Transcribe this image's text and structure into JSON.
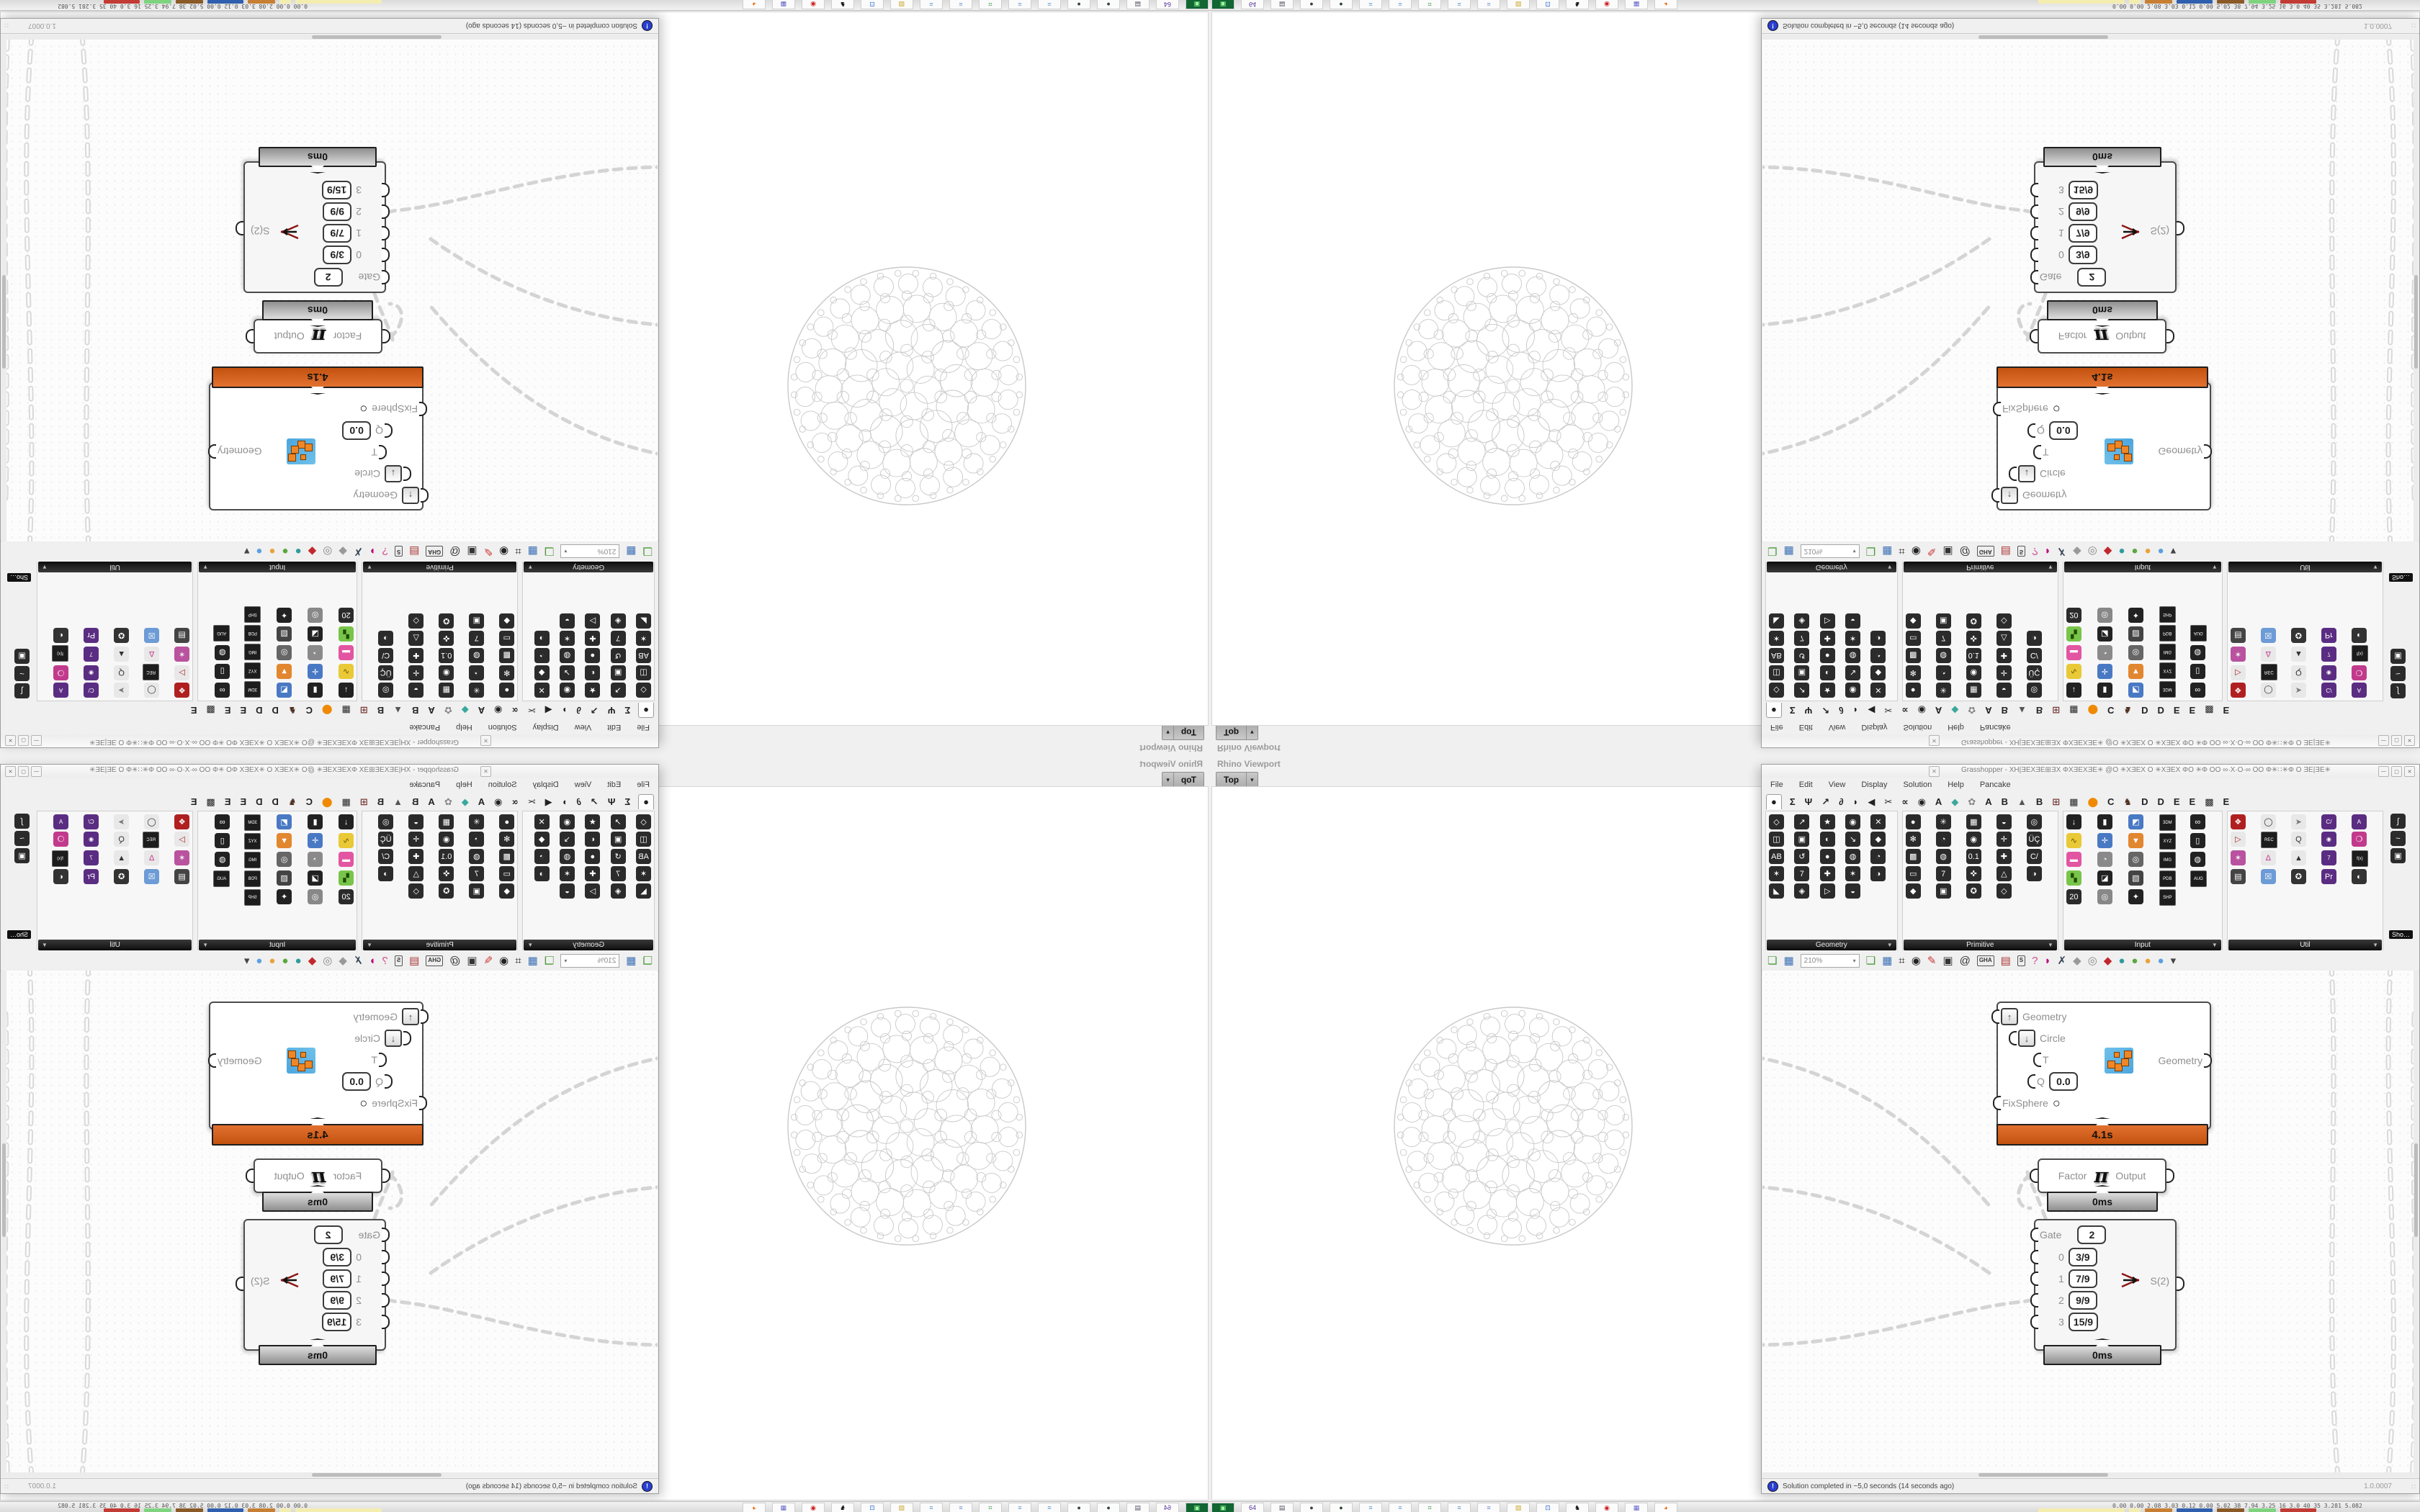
{
  "colors": {
    "chrome": "#f0f0f0",
    "canvas-bg": "#fcfcfc",
    "runtime": "#c4520f",
    "wire": "#d2d2d2"
  },
  "glyphs": {
    "dropdown": "▼",
    "small_down": "▾",
    "close": "✕",
    "minimize": "—",
    "maximize": "▢",
    "bang": "!",
    "grip": "∷"
  },
  "rhino": {
    "panel_title": "Rhino Viewport",
    "viewport_tab": "Top"
  },
  "gh": {
    "title": "Grasshopper - XH|ƎEXƎE⊞ƎX ΦXƎEXƎE✳ @O ✳XƎEX O ✳XƎEX ΦO ✳Φ OO ∞·X·O·∞ OO Φ✳∷✳Φ O ƎE|ƎE✳",
    "menu": [
      "File",
      "Edit",
      "View",
      "Display",
      "Solution",
      "Help",
      "Pancake"
    ],
    "tabs": [
      {
        "g": "●",
        "cls": "sel"
      },
      {
        "g": "Σ"
      },
      {
        "g": "Ψ"
      },
      {
        "g": "↗"
      },
      {
        "g": "∂"
      },
      {
        "g": "◗"
      },
      {
        "g": "◀"
      },
      {
        "g": "✂"
      },
      {
        "g": "∝"
      },
      {
        "g": "◉"
      },
      {
        "g": "A"
      },
      {
        "g": "◆",
        "fg": "#3aa89b"
      },
      {
        "g": "✿",
        "fg": "#888"
      },
      {
        "g": "A"
      },
      {
        "g": "B"
      },
      {
        "g": "▲",
        "fg": "#555"
      },
      {
        "g": "B"
      },
      {
        "g": "⊞",
        "fg": "#7a3c3c"
      },
      {
        "g": "▦"
      },
      {
        "g": "⬤",
        "fg": "#ef8a00"
      },
      {
        "g": "C"
      },
      {
        "g": "♞",
        "fg": "#4b2e1e"
      },
      {
        "g": "D"
      },
      {
        "g": "D"
      },
      {
        "g": "E"
      },
      {
        "g": "E"
      },
      {
        "g": "▩"
      },
      {
        "g": "E"
      }
    ],
    "palette": {
      "panels": [
        {
          "name": "Geometry",
          "cells": [
            "◇",
            "↗",
            "★",
            "◉",
            "✕",
            "◫",
            "▣",
            "◐",
            "↘",
            "◆",
            "AB",
            "↺",
            "●",
            "◍",
            "◔",
            "✶",
            "7",
            "✚",
            "✶",
            "◑",
            "◣",
            "◈",
            "▷",
            "◒"
          ]
        },
        {
          "name": "Primitive",
          "cells": [
            "●",
            "✳",
            "▦",
            "◒",
            "◎",
            "✻",
            "◔",
            "◉",
            "✛",
            "ÜÇ",
            "▩",
            "◍",
            "0.1",
            "✚",
            "C/",
            "▭",
            "7",
            "✜",
            "△",
            "◑",
            "◆",
            "▣",
            "✪",
            "◇"
          ]
        },
        {
          "name": "Input",
          "cells": [
            {
              "g": "↓",
              "bg": "#222"
            },
            {
              "g": "▮",
              "bg": "#222"
            },
            {
              "g": "◩",
              "bg": "#4a79c4"
            },
            {
              "g": "3DM",
              "cls": "chip"
            },
            {
              "g": "∞",
              "bg": "#222"
            },
            {
              "g": "∿",
              "bg": "#e9c937",
              "fg": "#6b5200"
            },
            {
              "g": "✛",
              "bg": "#4a79c4"
            },
            {
              "g": "▼",
              "bg": "#e2862f"
            },
            {
              "g": "XYZ",
              "cls": "chip"
            },
            {
              "g": "▯",
              "bg": "#222"
            },
            {
              "g": "▬",
              "bg": "#e255a2"
            },
            {
              "g": "◔",
              "bg": "#8a8a8a"
            },
            {
              "g": "◎",
              "bg": "#666"
            },
            {
              "g": "IMG",
              "cls": "chip"
            },
            {
              "g": "◍",
              "bg": "#222"
            },
            {
              "g": "▚",
              "bg": "#79c44a",
              "fg": "#1d4d00"
            },
            {
              "g": "◪",
              "bg": "#222"
            },
            {
              "g": "▧",
              "bg": "#444"
            },
            {
              "g": "PDB",
              "cls": "chip"
            },
            {
              "g": "AUG",
              "cls": "chip"
            },
            {
              "g": "20",
              "bg": "#2b2b2b"
            },
            {
              "g": "◎",
              "bg": "#888"
            },
            {
              "g": "✦",
              "bg": "#222"
            },
            {
              "g": "SHP",
              "cls": "chip"
            }
          ]
        },
        {
          "name": "Util",
          "cells": [
            {
              "g": "❖",
              "bg": "#b02020"
            },
            {
              "g": "◯",
              "bg": "#e8e8e8",
              "fg": "#333"
            },
            {
              "g": "➤",
              "bg": "#e8e8e8",
              "fg": "#777"
            },
            {
              "g": "C/",
              "cls": "chip-purple"
            },
            {
              "g": "A",
              "cls": "chip-purple"
            },
            {
              "g": "▷",
              "bg": "#e8e8e8",
              "fg": "#b02020"
            },
            {
              "g": "REC",
              "cls": "chip"
            },
            {
              "g": "Q",
              "bg": "#e8e8e8",
              "fg": "#333"
            },
            {
              "g": "◉",
              "cls": "chip-purple"
            },
            {
              "g": "❍",
              "bg": "#c23a8c"
            },
            {
              "g": "✶",
              "bg": "#b9529f"
            },
            {
              "g": "Δ",
              "bg": "#e8e8e8",
              "fg": "#c23a8c"
            },
            {
              "g": "▲",
              "bg": "#e8e8e8",
              "fg": "#333"
            },
            {
              "g": "7",
              "cls": "chip-purple"
            },
            {
              "g": "f(x)",
              "cls": "chip"
            },
            {
              "g": "▤",
              "bg": "#444"
            },
            {
              "g": "☒",
              "bg": "#6d9bd6"
            },
            {
              "g": "✪",
              "bg": "#333"
            },
            {
              "g": "Pr",
              "bg": "#5a2d82"
            },
            {
              "g": "◐",
              "bg": "#333"
            }
          ]
        }
      ],
      "extra_cells": [
        "∫",
        "~",
        "▣"
      ],
      "more_label": "Sho…"
    },
    "toolbar": {
      "zoom_value": "210%",
      "icons": [
        {
          "g": "❏",
          "fg": "#4a9a3a"
        },
        {
          "g": "▦",
          "fg": "#3b6fb5"
        },
        {
          "g": "⌗",
          "fg": "#222"
        },
        {
          "g": "◉",
          "fg": "#222"
        },
        {
          "g": "✎",
          "fg": "#c33"
        },
        {
          "g": "▣",
          "fg": "#333"
        },
        {
          "g": "@",
          "fg": "#333"
        },
        {
          "g": "GHA",
          "cls": "chip"
        },
        {
          "g": "▤",
          "fg": "#a33"
        },
        {
          "g": "S",
          "cls": "chip"
        },
        {
          "g": "?",
          "fg": "#d04a8e"
        },
        {
          "g": "◗",
          "fg": "#b07"
        },
        {
          "g": "✗",
          "fg": "#345"
        },
        {
          "g": "◆",
          "fg": "#999"
        },
        {
          "g": "◎",
          "fg": "#888"
        },
        {
          "g": "◆",
          "fg": "#c2272d"
        },
        {
          "g": "●",
          "fg": "#2e9c9c"
        },
        {
          "g": "●",
          "fg": "#58a83c"
        },
        {
          "g": "●",
          "fg": "#e8a23a"
        },
        {
          "g": "●",
          "fg": "#5aa0e0"
        },
        {
          "g": "▾",
          "fg": "#444"
        }
      ]
    },
    "canvas": {
      "main_component": {
        "time": "4.1s",
        "output": "Geometry",
        "inputs": [
          {
            "label": "Geometry",
            "arrow": "↑"
          },
          {
            "label": "Circle",
            "arrow": "↓",
            "cls": "r1"
          },
          {
            "label": "T",
            "cls": "r2"
          },
          {
            "label": "Q",
            "value": "0.0",
            "cls": "r3"
          },
          {
            "label": "FixSphere",
            "knob": "○",
            "cls": "r4"
          }
        ]
      },
      "pi_component": {
        "input": "Factor",
        "symbol": "π",
        "output": "Output",
        "time": "0ms"
      },
      "gate_component": {
        "gate_label": "Gate",
        "gate_value": "2",
        "rows": [
          {
            "i": "0",
            "v": "3/9"
          },
          {
            "i": "1",
            "v": "7/9"
          },
          {
            "i": "2",
            "v": "9/9"
          },
          {
            "i": "3",
            "v": "15/9"
          }
        ],
        "output": "S(2)",
        "time": "0ms"
      }
    },
    "statusbar": {
      "message": "Solution completed in ~5,0 seconds (14 seconds ago)",
      "version": "1.0.0007"
    }
  },
  "taskbar": {
    "icons": [
      {
        "g": "▣",
        "bg": "#163",
        "fg": "#9f9"
      },
      {
        "g": "64",
        "fg": "#539"
      },
      {
        "g": "▤",
        "fg": "#556"
      },
      {
        "g": "●",
        "fg": "#343"
      },
      {
        "g": "●",
        "fg": "#343"
      },
      {
        "g": "≡",
        "fg": "#69c"
      },
      {
        "g": "≡",
        "fg": "#69c"
      },
      {
        "g": "⌗",
        "fg": "#283"
      },
      {
        "g": "≡",
        "fg": "#69c"
      },
      {
        "g": "≡",
        "fg": "#69c"
      },
      {
        "g": "▨",
        "fg": "#ca3"
      },
      {
        "g": "⊡",
        "fg": "#36c"
      },
      {
        "g": "♞",
        "fg": "#111"
      },
      {
        "g": "◉",
        "fg": "#c22"
      },
      {
        "g": "▦",
        "fg": "#66c"
      },
      {
        "g": "◕",
        "fg": "#e60"
      }
    ],
    "stats": "0.00 0.00 2.08 3.03 0.12 0.00 5.02 38 7.94 3.25 16 3.0 40 35 3.281 5.082",
    "bars": [
      {
        "bg": "#f3eeb0",
        "w": 120
      },
      {
        "bg": "#f3eeb0",
        "w": 16
      },
      {
        "bg": "#c77f33",
        "w": 38
      },
      {
        "bg": "#2f5fae",
        "w": 50
      },
      {
        "bg": "#8a5a28",
        "w": 38
      },
      {
        "bg": "#7fd37f",
        "w": 38
      },
      {
        "bg": "#c23b35",
        "w": 50
      }
    ]
  }
}
